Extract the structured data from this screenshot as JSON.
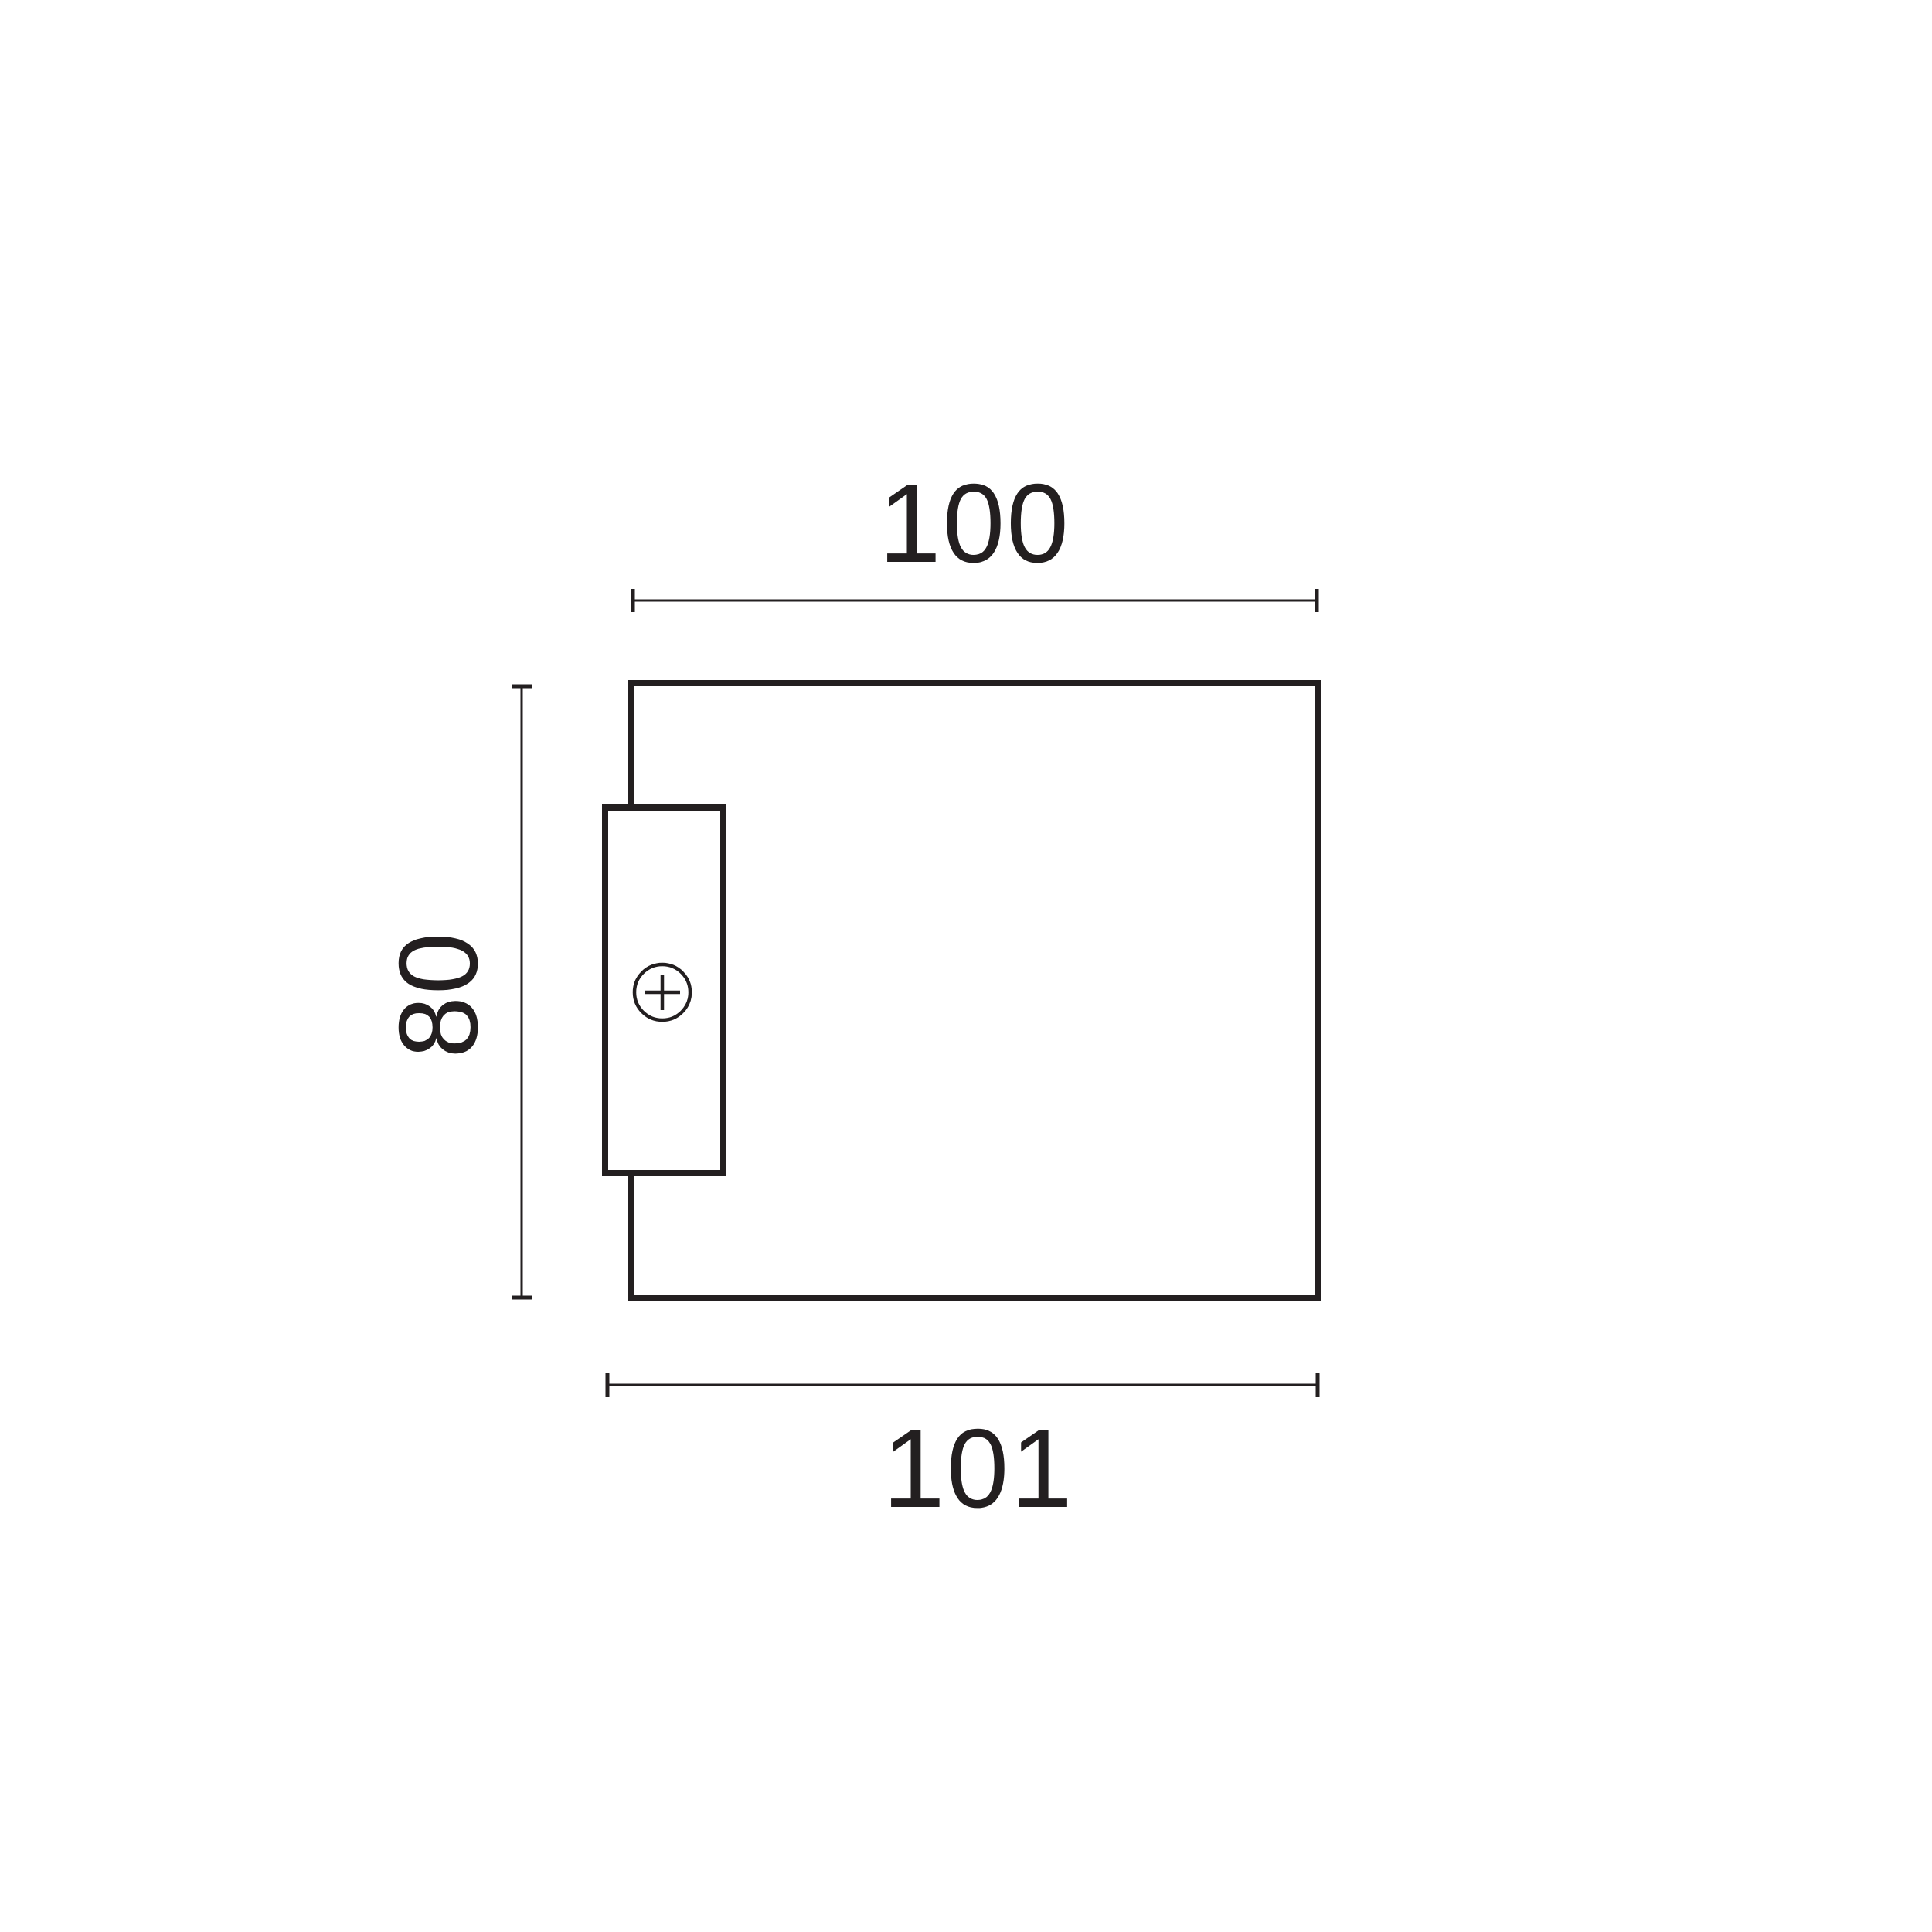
{
  "drawing": {
    "dimensions": {
      "width_top": "100",
      "height_left": "80",
      "width_bottom": "101"
    },
    "icons": {
      "screw": "circle-with-cross"
    },
    "colors": {
      "line": "#231f20",
      "background": "#ffffff"
    }
  }
}
